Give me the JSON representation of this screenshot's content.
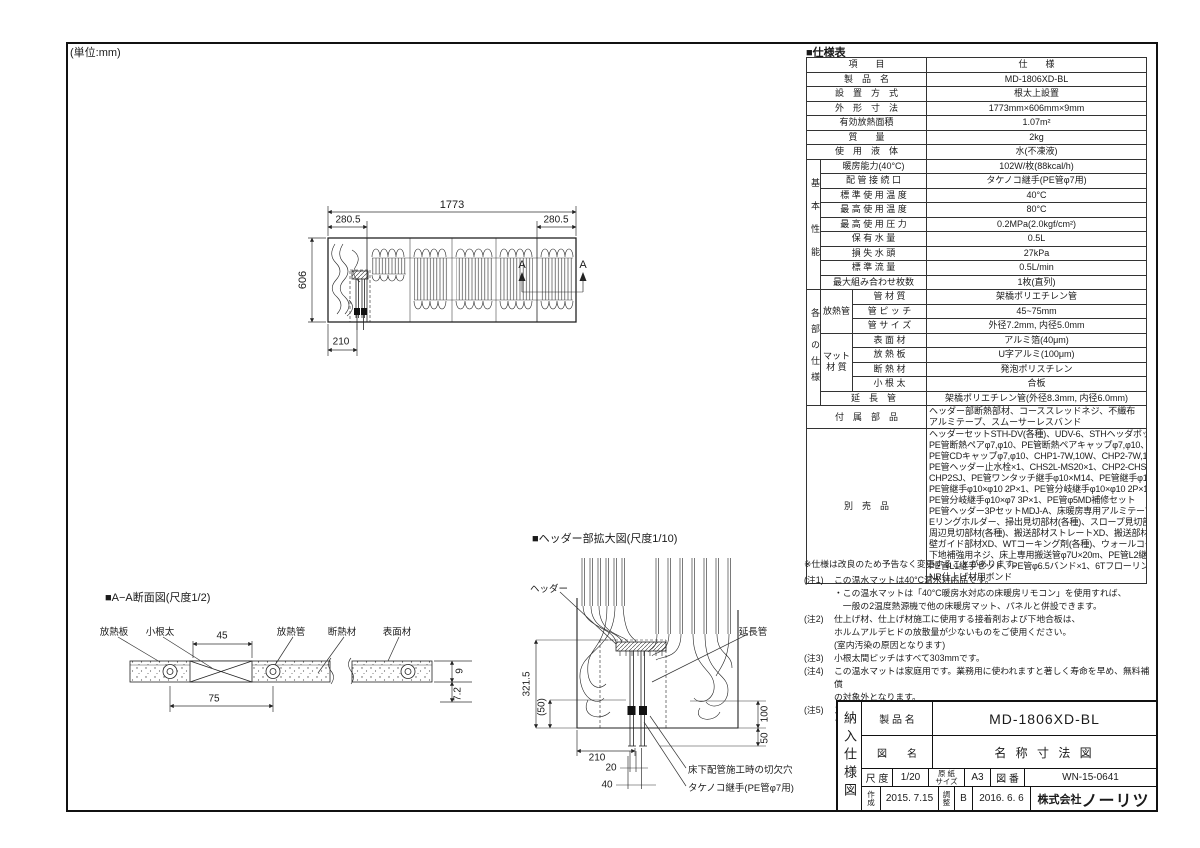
{
  "unit_note": "(単位:mm)",
  "spec": {
    "title": "■仕様表",
    "rows": {
      "header": {
        "l": "項　　目",
        "v": "仕　　様"
      },
      "product": {
        "l": "製　品　名",
        "v": "MD-1806XD-BL"
      },
      "install": {
        "l": "設　置　方　式",
        "v": "根太上設置"
      },
      "dims": {
        "l": "外　形　寸　法",
        "v": "1773mm×606mm×9mm"
      },
      "area": {
        "l": "有効放熱面積",
        "v": "1.07m²"
      },
      "mass": {
        "l": "質　　量",
        "v": "2kg"
      },
      "fluid": {
        "l": "使　用　液　体",
        "v": "水(不凍液)"
      }
    },
    "perf": {
      "group": "基本性能",
      "rows": [
        {
          "l": "暖房能力(40°C)",
          "v": "102W/枚(88kcal/h)"
        },
        {
          "l": "配 管 接 続 口",
          "v": "タケノコ継手(PE管φ7用)"
        },
        {
          "l": "標 準 使 用 温 度",
          "v": "40°C"
        },
        {
          "l": "最 高 使 用 温 度",
          "v": "80°C"
        },
        {
          "l": "最 高 使 用 圧 力",
          "v": "0.2MPa(2.0kgf/cm²)"
        },
        {
          "l": "保 有 水 量",
          "v": "0.5L"
        },
        {
          "l": "損 失 水 頭",
          "v": "27kPa"
        },
        {
          "l": "標 準 流 量",
          "v": "0.5L/min"
        },
        {
          "l": "最大組み合わせ枚数",
          "v": "1枚(直列)"
        }
      ]
    },
    "parts": {
      "group": "各部の仕様",
      "pipe_group": "放熱管",
      "pipe_rows": [
        {
          "l": "管 材 質",
          "v": "架橋ポリエチレン管"
        },
        {
          "l": "管 ピ ッ チ",
          "v": "45~75mm"
        },
        {
          "l": "管 サ イ ズ",
          "v": "外径7.2mm, 内径5.0mm"
        }
      ],
      "mat_group": "マット\n材 質",
      "mat_rows": [
        {
          "l": "表 面 材",
          "v": "アルミ箔(40μm)"
        },
        {
          "l": "放 熱 板",
          "v": "U字アルミ(100μm)"
        },
        {
          "l": "断 熱 材",
          "v": "発泡ポリスチレン"
        },
        {
          "l": "小 根 太",
          "v": "合板"
        }
      ],
      "ext": {
        "l": "延　長　管",
        "v": "架橋ポリエチレン管(外径8.3mm, 内径6.0mm)"
      }
    },
    "accessories": {
      "l": "付　属　部　品",
      "v": "ヘッダー部断熱部材、コーススレッドネジ、不織布\nアルミテープ、スムーサーレスバンド"
    },
    "optional": {
      "l": "別　売　品",
      "v": "ヘッダーセットSTH-DV(各種)、UDV-6、STHヘッダボックスM,S\nPE管断熱ペアφ7,φ10、PE管断熱ペアキャップφ7,φ10、PE管CD付φ7,φ10\nPE管CDキャップφ7,φ10、CHP1-7W,10W、CHP2-7W,10W\nPE管ヘッダー止水栓×1、CHS2L-MS20×1、CHP2-CHS2L-エルボ×1\nCHP2SJ、PE管ワンタッチ継手φ10×M14、PE管継手φ10×φ7×1\nPE管継手φ10×φ10 2P×1、PE管分岐継手φ10×φ10 2P×1\nPE管分岐継手φ10×φ7 3P×1、PE管φ5MD補修セット\nPE管ヘッダー3PセットMDJ-A、床暖房専用アルミテープ\nEリングホルダー、掃出見切部材(各種)、スロープ見切部材(各種)\n周辺見切部材(各種)、搬送部材ストレートXD、搬送部材コーナーXD\n壁ガイド部材XD、WTコーキング剤(各種)、ウォールコーナーSW-66セット\n下地補強用ネジ、床上専用搬送管φ7U×20m、PE管L2継手セット\nPE管L1継手セット、PE管φ6.5バンド×1、6Tフローリング(各種)\nNR仕上げ材用ボンド"
    }
  },
  "notes": {
    "disclaimer": "※仕様は改良のため予告なく変更することがあります。",
    "items": [
      {
        "no": "(注1)",
        "text": "この温水マットは40°C温水対応品です。\n・この温水マットは「40°C暖房水対応の床暖房リモコン」を使用すれば、\n　一般の2温度熱源機で他の床暖房マット、パネルと併設できます。"
      },
      {
        "no": "(注2)",
        "text": "仕上げ材、仕上げ材施工に使用する接着剤および下地合板は、\nホルムアルデヒドの放散量が少ないものをご使用ください。\n(室内汚染の原因となります)"
      },
      {
        "no": "(注3)",
        "text": "小根太間ピッチはすべて303mmです。"
      },
      {
        "no": "(注4)",
        "text": "この温水マットは家庭用です。業務用に使われますと著しく寿命を早め、無料補償\nの対象外となります。"
      },
      {
        "no": "(注5)",
        "text": "スラブ、コンクリートに直貼り施工はできません。根太床組、2重床(アジャスト\nフロアー)等、床下通気、搬送管経路の確保が必要です。"
      }
    ]
  },
  "plan": {
    "dim_total_width": "1773",
    "dim_left_cap": "280.5",
    "dim_right_cap": "280.5",
    "dim_height": "606",
    "dim_header_offset": "210",
    "section_marker_a1": "A",
    "section_marker_a2": "A"
  },
  "section": {
    "title": "■A−A断面図(尺度1/2)",
    "label_heat_plate": "放熱板",
    "label_small_joist": "小根太",
    "dim_45": "45",
    "label_heat_pipe": "放熱管",
    "label_insulation": "断熱材",
    "label_surface": "表面材",
    "dim_75": "75",
    "dim_9": "9",
    "dim_7_2": "7.2"
  },
  "header_detail": {
    "title": "■ヘッダー部拡大図(尺度1/10)",
    "label_header": "ヘッダー",
    "label_extension": "延長管",
    "dim_321_5": "321.5",
    "dim_50_paren": "(50)",
    "dim_100": "100",
    "dim_50": "50",
    "dim_210": "210",
    "dim_20": "20",
    "dim_40": "40",
    "label_cutout": "床下配管施工時の切欠穴",
    "label_fitting": "タケノコ継手(PE管φ7用)"
  },
  "title_block": {
    "doc_type": "納入仕様図",
    "product_label": "製 品 名",
    "product_value": "MD-1806XD-BL",
    "drawing_label": "図　　名",
    "drawing_value": "名 称 寸 法 図",
    "scale_label": "尺 度",
    "scale_value": "1/20",
    "paper_label": "原 紙\nサイズ",
    "paper_value": "A3",
    "number_label": "図 番",
    "number_value": "WN-15-0641",
    "created_label": "作\n成",
    "created_value": "2015. 7.15",
    "revised_label": "調\n整",
    "revised_value": "B",
    "revised_date": "2016. 6. 6",
    "company_prefix": "株式会社",
    "company_name": "ノーリツ"
  }
}
